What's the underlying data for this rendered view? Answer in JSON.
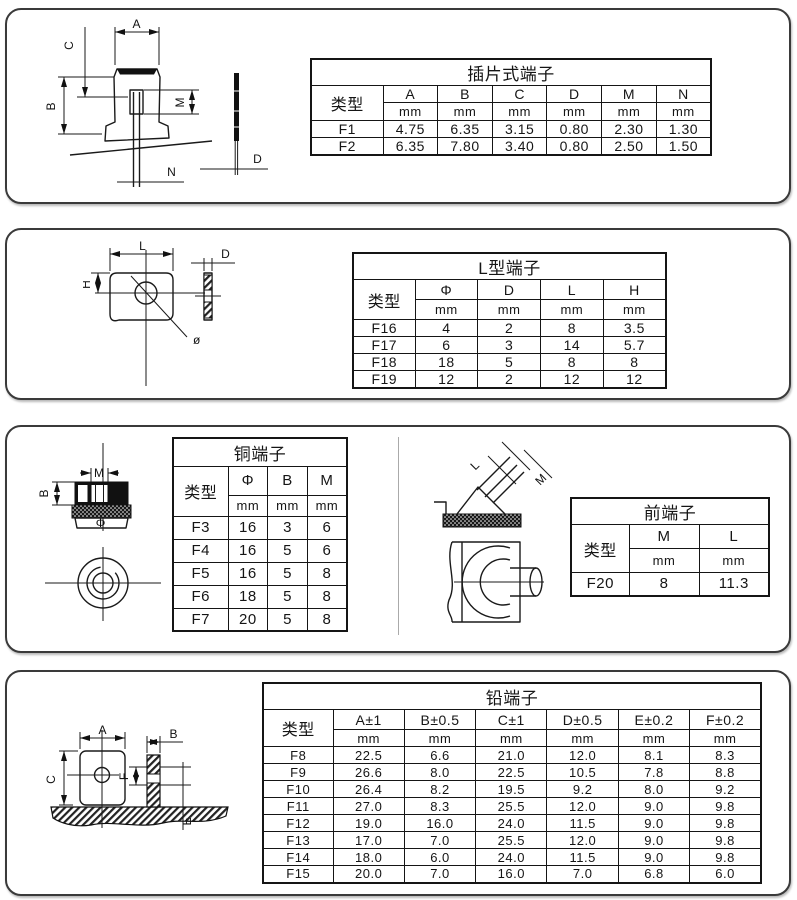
{
  "page": {
    "background": "#ffffff",
    "panel_border_color": "#3a3a3a",
    "line_color": "#1a1a1a",
    "divider_color": "#aaaaaa"
  },
  "panels": [
    {
      "name": "blade-terminal",
      "table": {
        "title": "插片式端子",
        "type_header": "类型",
        "unit": "mm",
        "columns": [
          "A",
          "B",
          "C",
          "D",
          "M",
          "N"
        ],
        "rows": [
          {
            "type": "F1",
            "values": [
              "4.75",
              "6.35",
              "3.15",
              "0.80",
              "2.30",
              "1.30"
            ]
          },
          {
            "type": "F2",
            "values": [
              "6.35",
              "7.80",
              "3.40",
              "0.80",
              "2.50",
              "1.50"
            ]
          }
        ]
      },
      "drawing": {
        "labels": {
          "A": "A",
          "B": "B",
          "C": "C",
          "M": "M",
          "N": "N",
          "D": "D"
        }
      }
    },
    {
      "name": "l-type-terminal",
      "table": {
        "title": "L型端子",
        "type_header": "类型",
        "unit": "mm",
        "columns": [
          "Φ",
          "D",
          "L",
          "H"
        ],
        "rows": [
          {
            "type": "F16",
            "values": [
              "4",
              "2",
              "8",
              "3.5"
            ]
          },
          {
            "type": "F17",
            "values": [
              "6",
              "3",
              "14",
              "5.7"
            ]
          },
          {
            "type": "F18",
            "values": [
              "18",
              "5",
              "8",
              "8"
            ]
          },
          {
            "type": "F19",
            "values": [
              "12",
              "2",
              "12",
              "12"
            ]
          }
        ]
      },
      "drawing": {
        "labels": {
          "L": "L",
          "H": "H",
          "D": "D",
          "dia": "ø"
        }
      }
    },
    {
      "name": "copper-terminal",
      "table": {
        "title": "铜端子",
        "type_header": "类型",
        "unit": "mm",
        "columns": [
          "Φ",
          "B",
          "M"
        ],
        "rows": [
          {
            "type": "F3",
            "values": [
              "16",
              "3",
              "6"
            ]
          },
          {
            "type": "F4",
            "values": [
              "16",
              "5",
              "6"
            ]
          },
          {
            "type": "F5",
            "values": [
              "16",
              "5",
              "8"
            ]
          },
          {
            "type": "F6",
            "values": [
              "18",
              "5",
              "8"
            ]
          },
          {
            "type": "F7",
            "values": [
              "20",
              "5",
              "8"
            ]
          }
        ]
      },
      "drawing": {
        "labels": {
          "M": "M",
          "B": "B",
          "phi": "Φ"
        }
      }
    },
    {
      "name": "front-terminal",
      "table": {
        "title": "前端子",
        "type_header": "类型",
        "unit": "mm",
        "columns": [
          "M",
          "L"
        ],
        "rows": [
          {
            "type": "F20",
            "values": [
              "8",
              "11.3"
            ]
          }
        ]
      },
      "drawing": {
        "labels": {
          "L": "L",
          "M": "M"
        }
      }
    },
    {
      "name": "lead-terminal",
      "table": {
        "title": "铅端子",
        "type_header": "类型",
        "unit": "mm",
        "columns": [
          "A±1",
          "B±0.5",
          "C±1",
          "D±0.5",
          "E±0.2",
          "F±0.2"
        ],
        "rows": [
          {
            "type": "F8",
            "values": [
              "22.5",
              "6.6",
              "21.0",
              "12.0",
              "8.1",
              "8.3"
            ]
          },
          {
            "type": "F9",
            "values": [
              "26.6",
              "8.0",
              "22.5",
              "10.5",
              "7.8",
              "8.8"
            ]
          },
          {
            "type": "F10",
            "values": [
              "26.4",
              "8.2",
              "19.5",
              "9.2",
              "8.0",
              "9.2"
            ]
          },
          {
            "type": "F11",
            "values": [
              "27.0",
              "8.3",
              "25.5",
              "12.0",
              "9.0",
              "9.8"
            ]
          },
          {
            "type": "F12",
            "values": [
              "19.0",
              "16.0",
              "24.0",
              "11.5",
              "9.0",
              "9.8"
            ]
          },
          {
            "type": "F13",
            "values": [
              "17.0",
              "7.0",
              "25.5",
              "12.0",
              "9.0",
              "9.8"
            ]
          },
          {
            "type": "F14",
            "values": [
              "18.0",
              "6.0",
              "24.0",
              "11.5",
              "9.0",
              "9.8"
            ]
          },
          {
            "type": "F15",
            "values": [
              "20.0",
              "7.0",
              "16.0",
              "7.0",
              "6.8",
              "6.0"
            ]
          }
        ]
      },
      "drawing": {
        "labels": {
          "A": "A",
          "B": "B",
          "C": "C",
          "E": "E",
          "F": "F"
        }
      }
    }
  ]
}
